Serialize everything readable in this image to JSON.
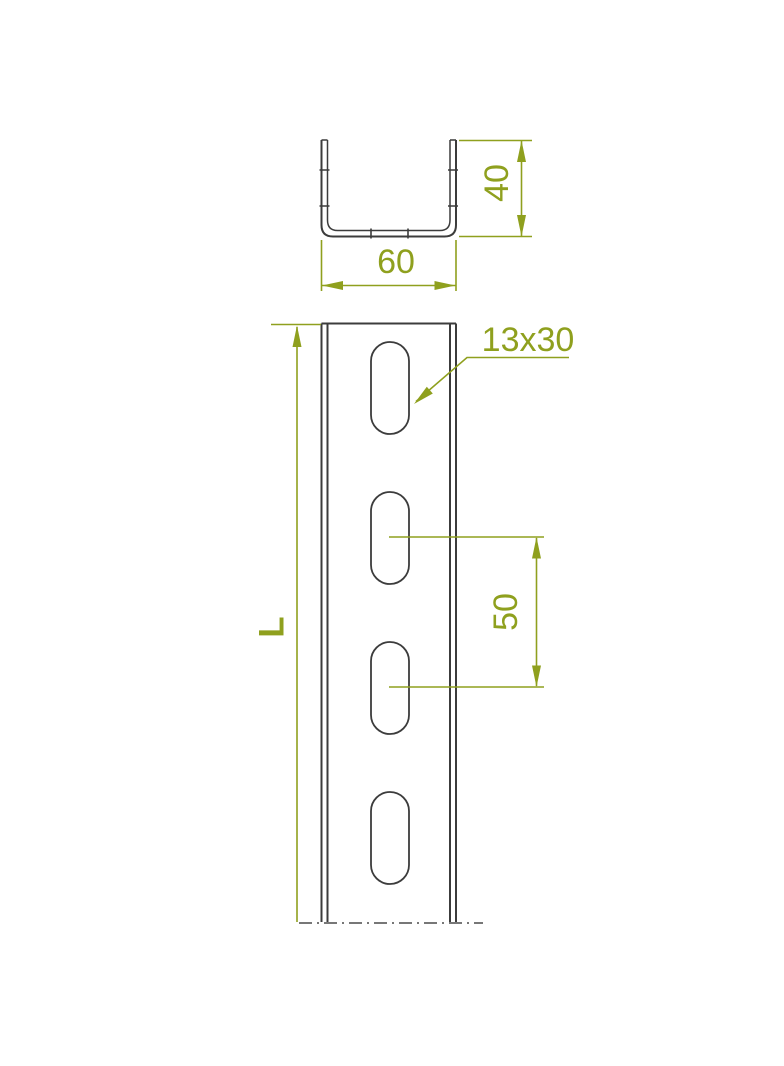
{
  "title": "U-channel profile technical drawing",
  "labels": {
    "width": "60",
    "height": "40",
    "slot_size": "13x30",
    "slot_pitch": "50",
    "length": "L"
  },
  "colors": {
    "dimension": "#8FA01E",
    "line": "#3C3C3C",
    "break_line": "#4A4A4A",
    "background": "#FFFFFF"
  },
  "drawing": {
    "views": [
      "cross-section",
      "front"
    ],
    "cross_section": {
      "width_label": "60",
      "height_label": "40"
    },
    "front_view": {
      "slot_label": "13x30",
      "slot_pitch_label": "50",
      "length_label": "L",
      "visible_slot_count": 4
    }
  }
}
